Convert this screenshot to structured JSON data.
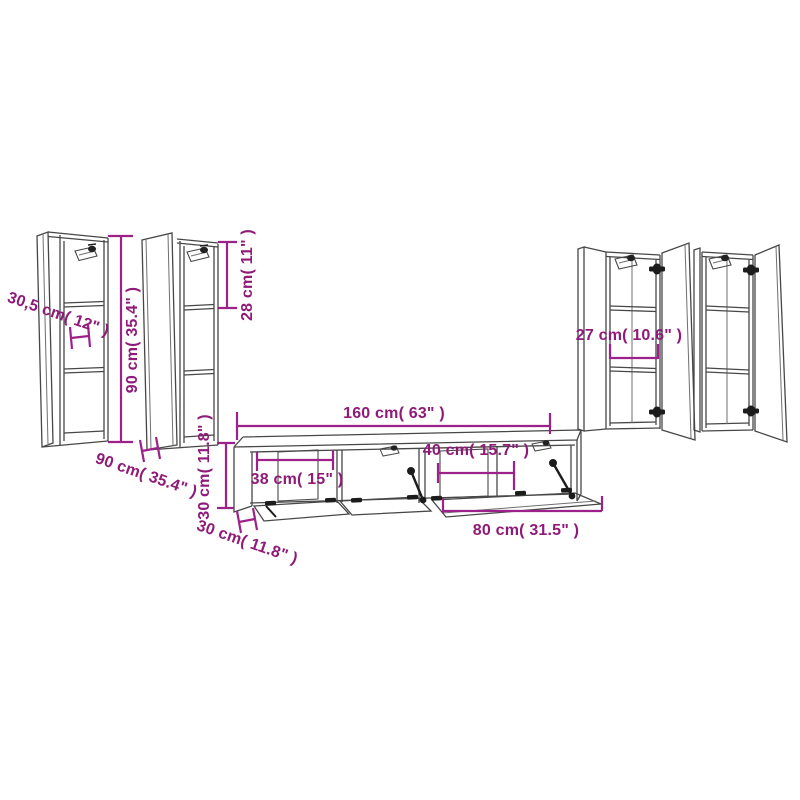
{
  "image": {
    "background": "#ffffff",
    "annotation_color": "#9B1C85",
    "line_art_color": "#4a4a4a",
    "hardware_color": "#1c1c1c"
  },
  "dimensions": {
    "tall_cabinet_left": {
      "depth": "30,5 cm( 12\" )",
      "height": "90 cm( 35.4\" )"
    },
    "tall_cabinet_left_2": {
      "top_compartment": "28 cm( 11\" )",
      "height_diagonal": "90 cm( 35.4\" )"
    },
    "tv_cabinet_row": {
      "total_width": "160 cm( 63\" )",
      "left_compartment_width": "38 cm( 15\" )",
      "right_compartment_width": "40 cm( 15.7\" )",
      "single_cabinet_width": "80 cm( 31.5\" )",
      "height": "30 cm( 11.8\" )",
      "depth": "30 cm( 11.8\" )"
    },
    "tall_cabinet_right": {
      "width": "27 cm( 10.6\" )"
    }
  }
}
